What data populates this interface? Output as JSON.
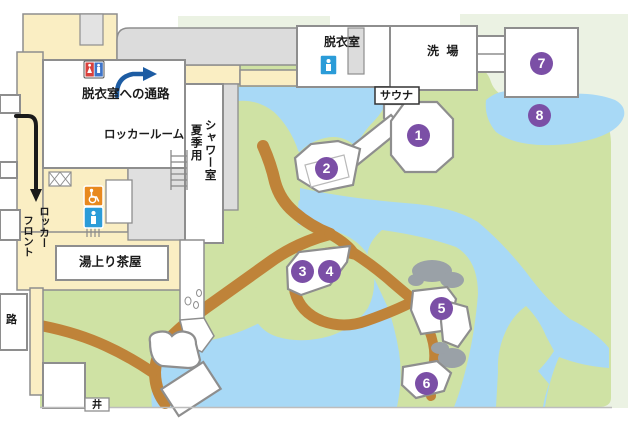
{
  "labels": {
    "passage_to_dressing_room": "脱衣室への通路",
    "locker_room": "ロッカールーム",
    "summer_use": "夏季用",
    "shower_room": "シャワー室",
    "dressing_room": "脱衣室",
    "washing_area": "洗 場",
    "sauna": "サウナ",
    "locker_front_line1": "ロッカー",
    "locker_front_line2": "フロント",
    "tea_house": "湯上り茶屋",
    "path_partial": "路",
    "well_partial": "井"
  },
  "markers": [
    {
      "label": "1"
    },
    {
      "label": "2"
    },
    {
      "label": "3"
    },
    {
      "label": "4"
    },
    {
      "label": "5"
    },
    {
      "label": "6"
    },
    {
      "label": "7"
    },
    {
      "label": "8"
    }
  ],
  "icons": {
    "restroom_pair": "male-female-restroom-icon",
    "toilet_dressing": "toilet-icon",
    "wheelchair": "wheelchair-accessible-icon",
    "toilet_locker": "toilet-icon",
    "stairs": "stairs-icon",
    "route_blue": "blue-route-arrow",
    "route_black": "black-route-arrow"
  },
  "colors": {
    "grass": "#cfe2a4",
    "water": "#a8d9f6",
    "path": "#bf8339",
    "corridor": "#faeec3",
    "roof": "#dcdcdc",
    "pale": "#ebf2e3",
    "marker": "#7b4fa6",
    "room": "#ffffff",
    "border": "#8e8e8e",
    "rock": "#9aa1a7",
    "arrowBlue": "#1d5ca3",
    "arrowBlack": "#1a1a1a",
    "toiletBlue": "#2b9cd8",
    "femaleRed": "#d9413c",
    "maleBlue": "#3e74c9",
    "wheelchairOrange": "#e8891e",
    "text": "#1b1b1b"
  }
}
